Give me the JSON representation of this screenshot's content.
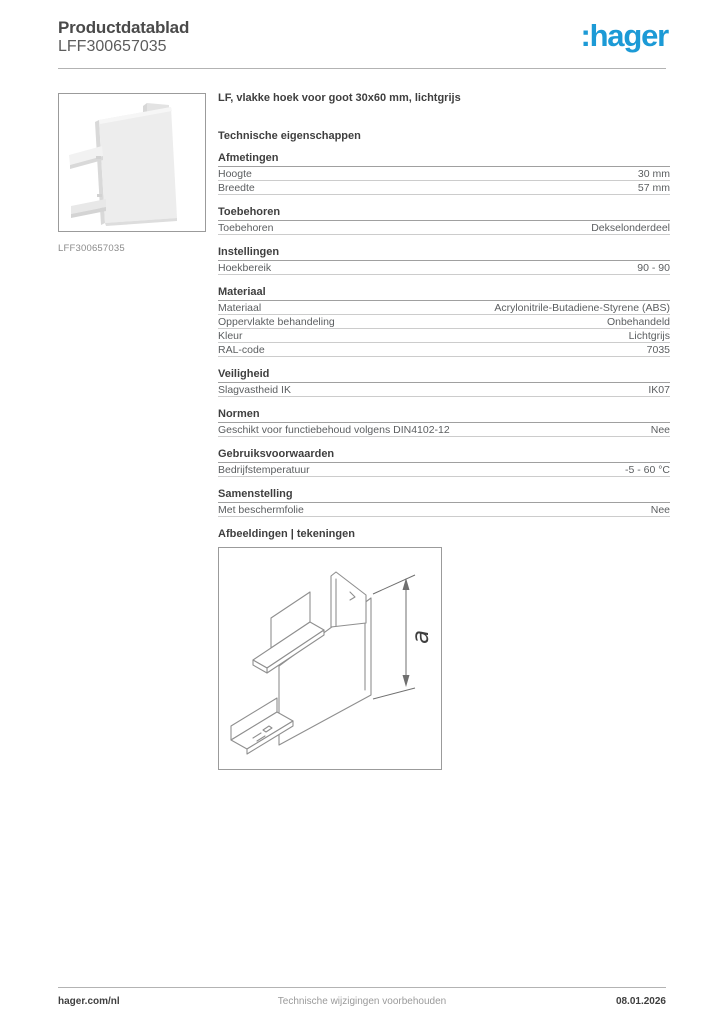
{
  "header": {
    "title": "Productdatablad",
    "reference": "LFF300657035",
    "logo_text": ":hager",
    "logo_color": "#1c9ad6"
  },
  "product": {
    "image_caption": "LFF300657035",
    "title": "LF, vlakke hoek voor goot 30x60 mm, lichtgrijs"
  },
  "technical": {
    "heading": "Technische eigenschappen",
    "sections": [
      {
        "heading": "Afmetingen",
        "rows": [
          {
            "label": "Hoogte",
            "value": "30 mm"
          },
          {
            "label": "Breedte",
            "value": "57 mm"
          }
        ]
      },
      {
        "heading": "Toebehoren",
        "rows": [
          {
            "label": "Toebehoren",
            "value": "Dekselonderdeel"
          }
        ]
      },
      {
        "heading": "Instellingen",
        "rows": [
          {
            "label": "Hoekbereik",
            "value": "90 - 90"
          }
        ]
      },
      {
        "heading": "Materiaal",
        "rows": [
          {
            "label": "Materiaal",
            "value": "Acrylonitrile-Butadiene-Styrene (ABS)"
          },
          {
            "label": "Oppervlakte behandeling",
            "value": "Onbehandeld"
          },
          {
            "label": "Kleur",
            "value": "Lichtgrijs"
          },
          {
            "label": "RAL-code",
            "value": "7035"
          }
        ]
      },
      {
        "heading": "Veiligheid",
        "rows": [
          {
            "label": "Slagvastheid IK",
            "value": "IK07"
          }
        ]
      },
      {
        "heading": "Normen",
        "rows": [
          {
            "label": "Geschikt voor functiebehoud volgens DIN4102-12",
            "value": "Nee"
          }
        ]
      },
      {
        "heading": "Gebruiksvoorwaarden",
        "rows": [
          {
            "label": "Bedrijfstemperatuur",
            "value": "-5 - 60 °C"
          }
        ]
      },
      {
        "heading": "Samenstelling",
        "rows": [
          {
            "label": "Met beschermfolie",
            "value": "Nee"
          }
        ]
      }
    ]
  },
  "drawings": {
    "heading": "Afbeeldingen | tekeningen",
    "dimension_label": "a"
  },
  "footer": {
    "left": "hager.com/nl",
    "center": "Technische wijzigingen voorbehouden",
    "right": "08.01.2026"
  }
}
